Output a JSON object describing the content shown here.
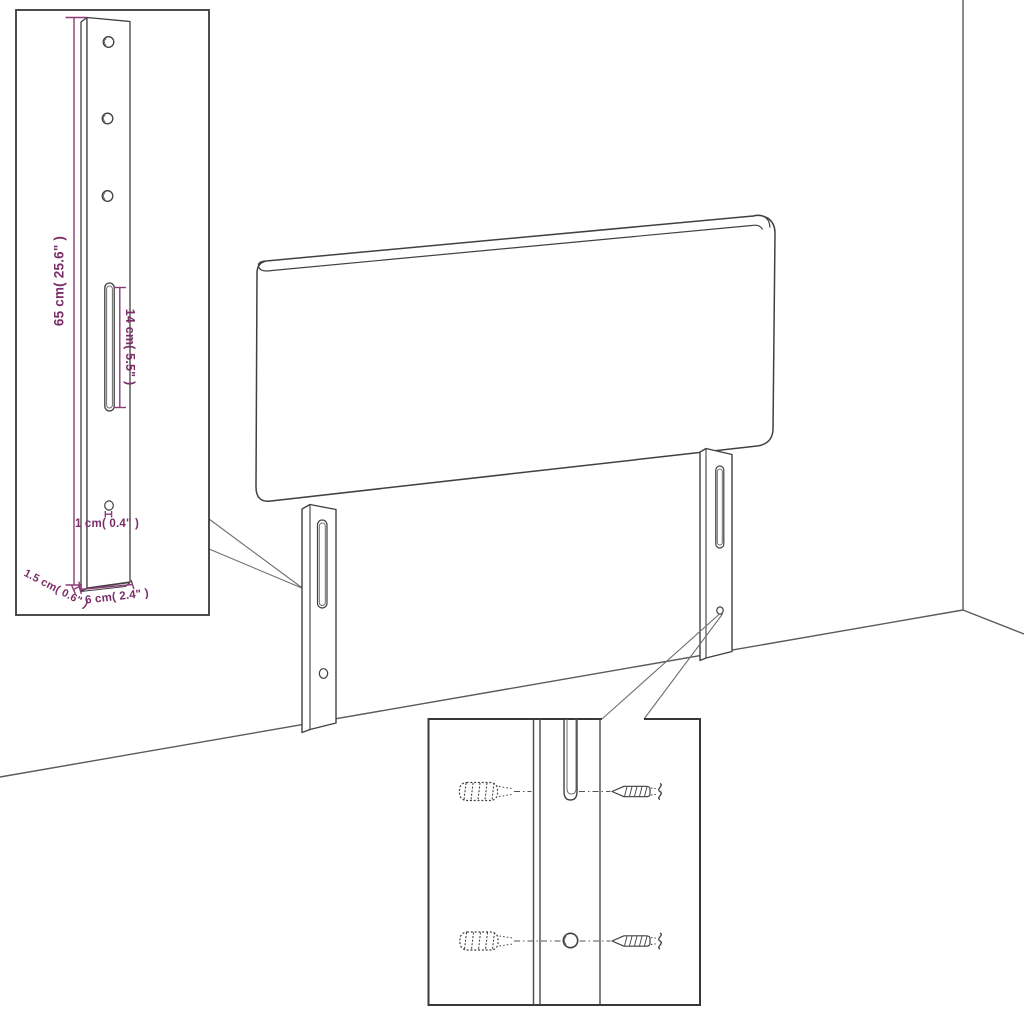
{
  "diagram": {
    "kind": "furniture-assembly-dimension-diagram",
    "subject": "upholstered headboard with two mounting legs shown against a room corner",
    "colors": {
      "background": "#ffffff",
      "line_art": "#414141",
      "dimension_text": "#7b2d68",
      "dimension_lines": "#8d3a79"
    },
    "legend": {
      "main_view": "headboard-with-legs",
      "inset_top_left": "leg-dimension-detail",
      "inset_bottom": "wall-plug-and-screw-mounting-detail"
    }
  },
  "dims": {
    "leg_height": "65 cm( 25.6\" )",
    "slot_length": "14 cm( 5.5\" )",
    "hole_diameter": "1 cm( 0.4\" )",
    "leg_thickness": "1.5 cm( 0.6\" )",
    "leg_width": "6 cm( 2.4\" )"
  }
}
